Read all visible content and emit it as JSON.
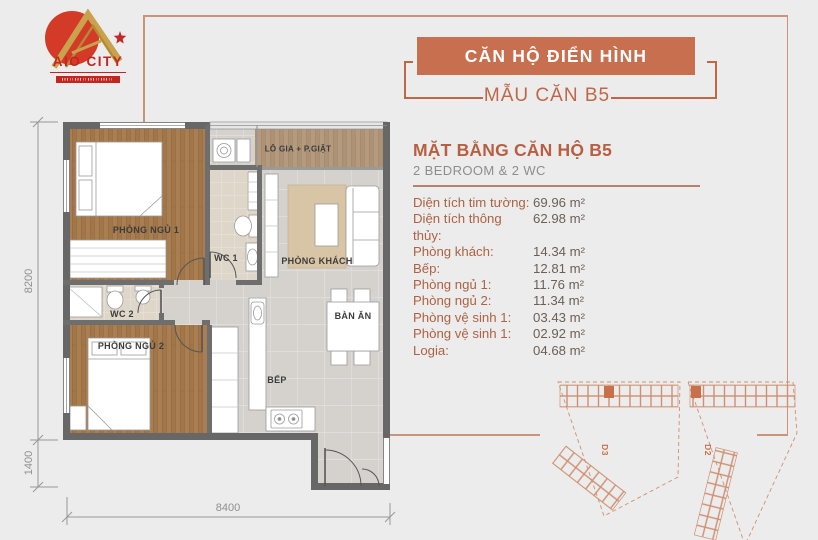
{
  "logo": {
    "name": "AIO CITY"
  },
  "banner": {
    "title": "CĂN HỘ ĐIỂN HÌNH",
    "subtitle": "MẪU CĂN B5"
  },
  "info": {
    "title": "MẶT BẰNG CĂN HỘ B5",
    "subtitle": "2 BEDROOM & 2 WC",
    "specs": [
      {
        "label": "Diện tích tim tường:",
        "value": "69.96 m²"
      },
      {
        "label": "Diện tích thông thủy:",
        "value": "62.98 m²"
      },
      {
        "label": "Phòng khách:",
        "value": "14.34 m²"
      },
      {
        "label": "Bếp:",
        "value": "12.81 m²"
      },
      {
        "label": "Phòng ngủ 1:",
        "value": "11.76 m²"
      },
      {
        "label": "Phòng ngủ 2:",
        "value": "11.34 m²"
      },
      {
        "label": "Phòng vệ sinh 1:",
        "value": "03.43 m²"
      },
      {
        "label": "Phòng vệ sinh 1:",
        "value": "02.92 m²"
      },
      {
        "label": "Logia:",
        "value": "04.68 m²"
      }
    ]
  },
  "floorplan": {
    "rooms": {
      "loggia": "LÔ GIA + P.GIẶT",
      "bedroom1": "PHÒNG NGỦ 1",
      "wc1": "WC 1",
      "living": "PHÒNG KHÁCH",
      "wc2": "WC 2",
      "bedroom2": "PHÒNG NGỦ 2",
      "dining": "BÀN ĂN",
      "kitchen": "BẾP"
    },
    "dimensions": {
      "left_upper": "8200",
      "left_lower": "1400",
      "bottom": "8400"
    }
  },
  "siteplan": {
    "blocks": [
      "D3",
      "D2"
    ]
  },
  "colors": {
    "background": "#ececec",
    "accent": "#c76f4e",
    "accent_text": "#bf6747",
    "frame": "#c99479",
    "wall": "#676767",
    "spec_label": "#ad6243",
    "spec_value": "#6d5f55",
    "logo_red": "#c3261f",
    "siteplan_line": "#cf8f70"
  }
}
